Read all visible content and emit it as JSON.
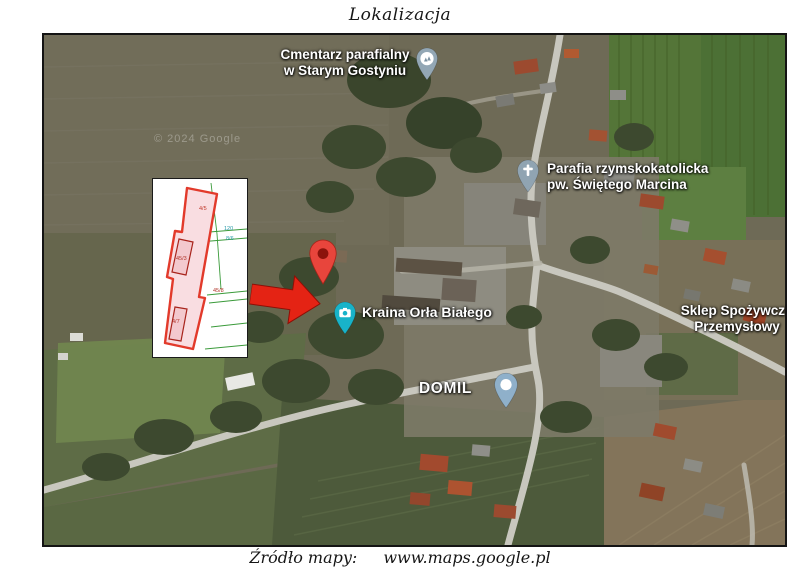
{
  "page": {
    "title": "Lokalizacja",
    "source_label": "Źródło mapy:",
    "source_url": "www.maps.google.pl"
  },
  "map": {
    "watermark": "© 2024 Google",
    "pois": {
      "cemetery": {
        "line1": "Cmentarz parafialny",
        "line2": "w Starym Gostyniu"
      },
      "parish": {
        "line1": "Parafia rzymskokatolicka",
        "line2": "pw. Świętego Marcina"
      },
      "kraina": {
        "line1": "Kraina Orła Białego"
      },
      "domil": {
        "line1": "DOMIL"
      },
      "sklep": {
        "line1": "Sklep Spożywczo",
        "line2": "Przemysłowy"
      }
    },
    "colors": {
      "marker_red": "#e8453c",
      "arrow_red": "#e42314",
      "pin_teal": "#18b3c9",
      "pin_blue": "#8fb0ca",
      "pin_gray": "#93a7b5",
      "parcel_stroke": "#e23a2b",
      "parcel_fill": "#f9dde1",
      "boundary_green": "#3a9a3a"
    },
    "inset_labels": {
      "parcel_top": "4/5",
      "ref_a": "120",
      "ref_b": "8/6",
      "building_mid": "45/3",
      "parcel_right": "45/8",
      "building_bottom": "4/7"
    }
  }
}
